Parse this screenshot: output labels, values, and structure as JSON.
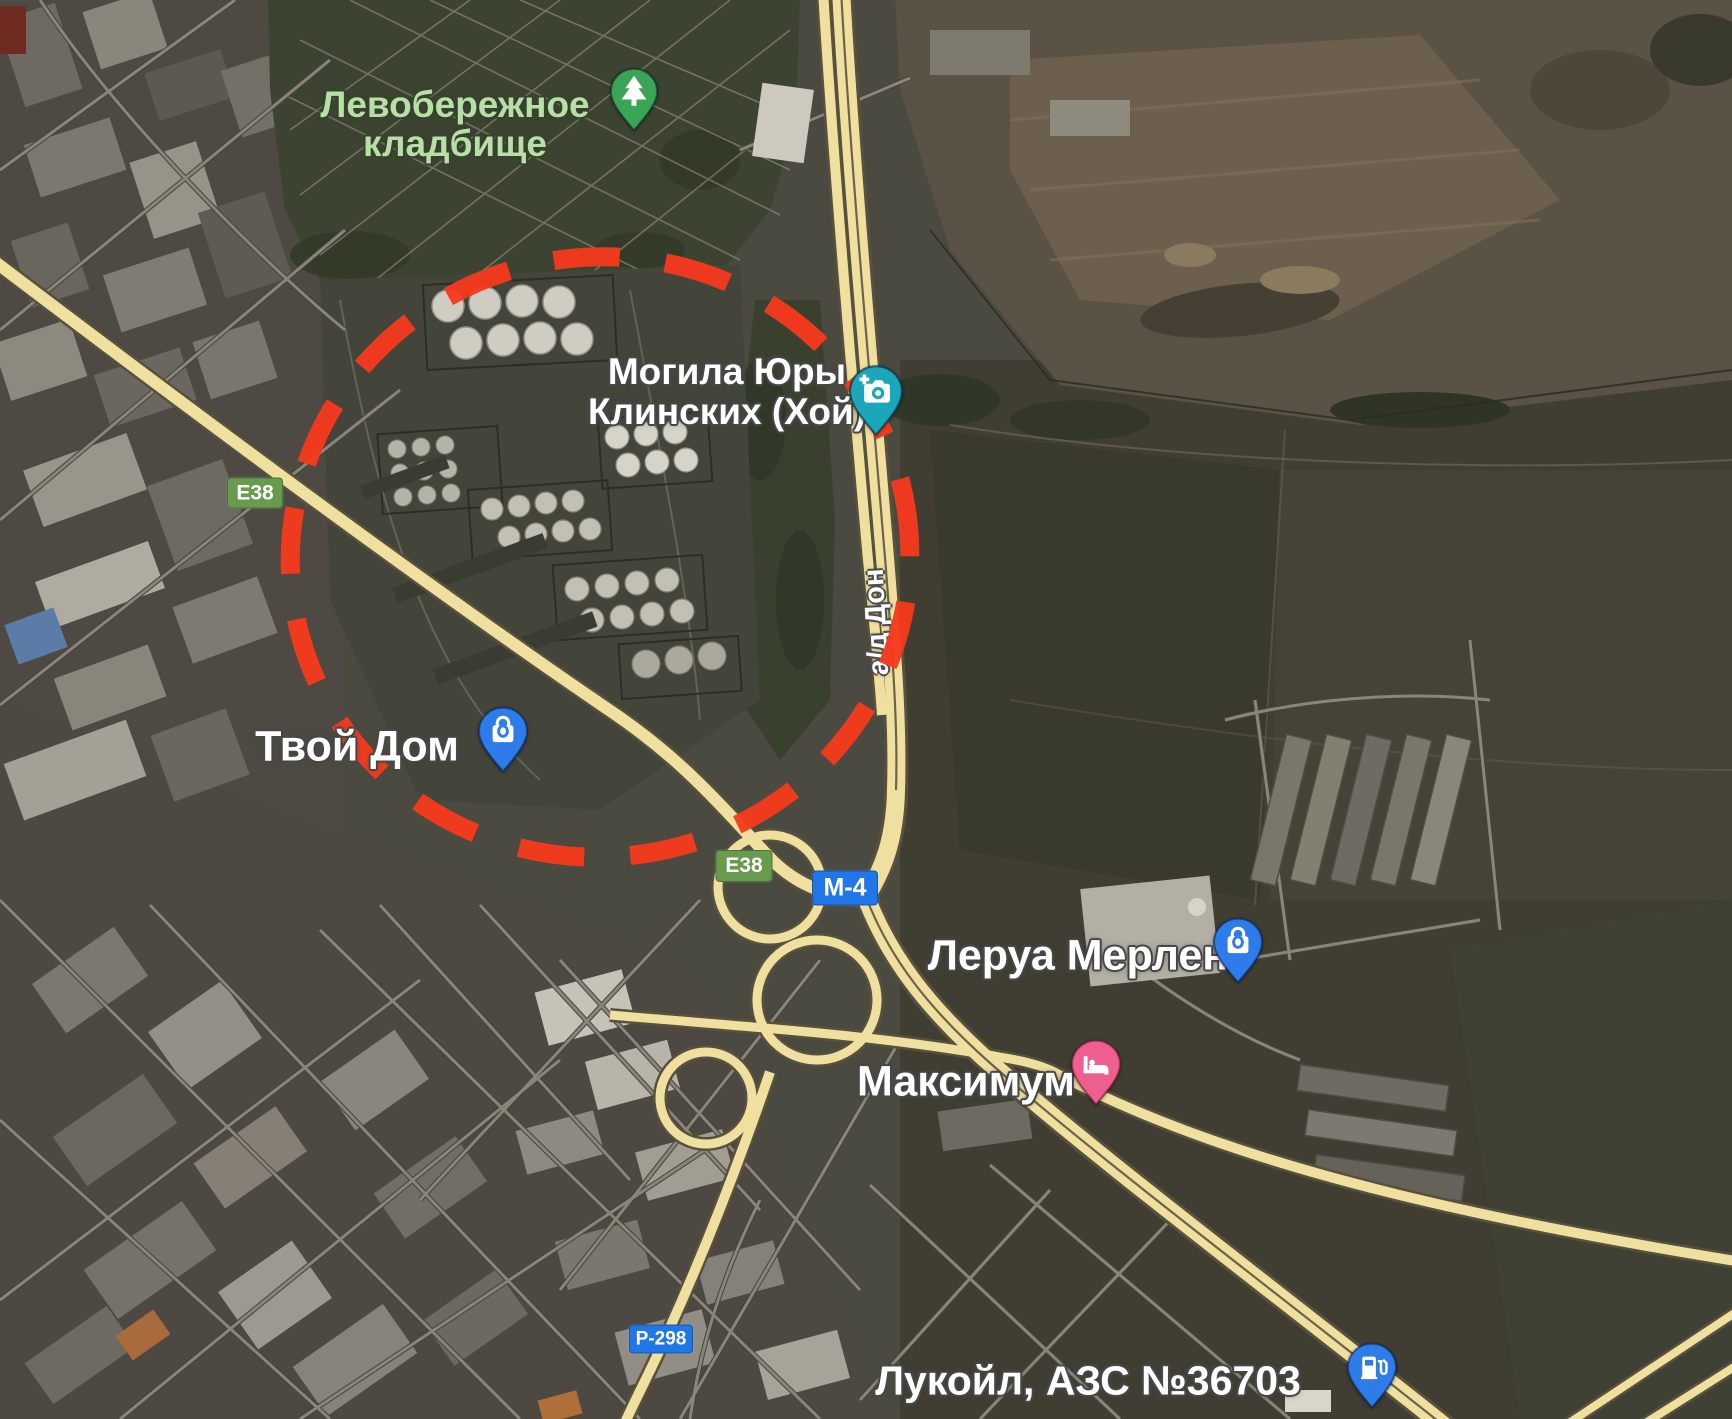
{
  "map": {
    "view_type": "satellite",
    "pois": {
      "cemetery": {
        "line1": "Левобережное",
        "line2": "кладбище",
        "icon": "tree-pin",
        "pin_color": "#3ba556",
        "text_color": "#b7dfa7"
      },
      "grave": {
        "line1": "Могила Юры",
        "line2": "Клинских (Хой)",
        "icon": "camera-pin",
        "pin_color": "#1ba6ba",
        "text_color": "#ffffff"
      },
      "tvoy_dom": {
        "label": "Твой Дом",
        "icon": "shopping-pin",
        "pin_color": "#2d7ce9",
        "text_color": "#ffffff"
      },
      "leroy_merlin": {
        "label": "Леруа Мерлен",
        "icon": "shopping-pin",
        "pin_color": "#2d7ce9",
        "text_color": "#ffffff"
      },
      "maximum": {
        "label": "Максимум",
        "icon": "hotel-pin",
        "pin_color": "#ee5f8f",
        "text_color": "#ffffff"
      },
      "lukoil": {
        "label": "Лукойл, АЗС №36703",
        "icon": "fuel-pin",
        "pin_color": "#2d7ce9",
        "text_color": "#ffffff"
      }
    },
    "route_badges": {
      "e38_nw": {
        "text": "E38",
        "bg": "#689b4e"
      },
      "e38_center": {
        "text": "E38",
        "bg": "#689b4e"
      },
      "m4": {
        "text": "М-4",
        "bg": "#2277e8"
      },
      "p298": {
        "text": "Р-298",
        "bg": "#2277e8"
      }
    },
    "road_labels": {
      "don": {
        "text": "а/д Дон"
      }
    },
    "annotation": {
      "shape": "hand-drawn-dashed-ellipse",
      "color": "#f53a1d"
    },
    "palette": {
      "road_fill": "#f0e0a0",
      "road_casing": "#57513d"
    }
  }
}
